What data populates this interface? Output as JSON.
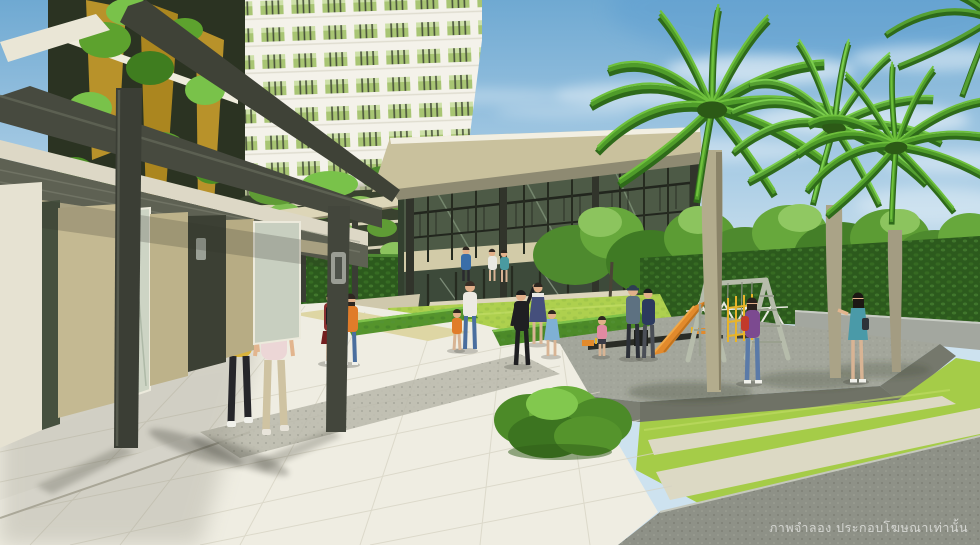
{
  "image": {
    "type": "architectural-rendering",
    "subject": "Condominium courtyard: high-rise tower with vertical gardens, glass clubhouse, playground with wooden swing set and slide, tall fan palms, lawns, hedges and residents walking",
    "width": 980,
    "height": 545
  },
  "watermark": {
    "text": "ภาพจำลอง ประกอบโฆษณาเท่านั้น",
    "meaning": "Simulated image, for advertising purposes only",
    "color": "#ffffff"
  },
  "palette": {
    "sky_top": "#6fa9d2",
    "sky_horizon": "#cde2ef",
    "tower_facade": "#f3f1e8",
    "window_glass": "#9dbd60",
    "window_frame": "#2f3a20",
    "gold_panel": "#b8922a",
    "vine_green": "#5da22e",
    "roof_fascia": "#c9c19d",
    "structure_dark": "#44473c",
    "wall_beige": "#bdb28c",
    "hedge_dark": "#2c5a1d",
    "hedge_bright": "#55942c",
    "lawn_green": "#a8cf4a",
    "pavement_light": "#eceadf",
    "paving_dark": "#8e9187",
    "platform_grey": "#a3a69b",
    "palm_trunk": "#b3ac8d",
    "palm_leaf": "#4f9c2a",
    "slide_orange": "#e28a2c",
    "swing_wood": "#b6bcab",
    "seesaw_dark": "#2a2c26"
  },
  "scene": {
    "buildings": [
      {
        "name": "residential-tower",
        "description": "white high-rise, grid of green glass windows, upper left"
      },
      {
        "name": "left-wing-vertical-garden",
        "description": "gold panels overgrown with climbing vines, steel pergola walkway in front"
      },
      {
        "name": "parking-podium",
        "description": "slab edges with hanging vine curtains behind green hedge wall"
      },
      {
        "name": "clubhouse",
        "description": "two-storey glass pavilion with wide flat roof, balcony railing, entry steps"
      }
    ],
    "playground": {
      "platform": "raised grey granite terrace",
      "equipment": [
        "wooden A-frame swing set",
        "orange slide",
        "yellow climbing frame",
        "black seesaw with orange seats",
        "white trestle fence"
      ]
    },
    "vegetation": [
      "three tall fan palms",
      "row of broadleaf trees",
      "trimmed hedge wall",
      "bright hedge blocks",
      "striped lawns"
    ],
    "people": [
      {
        "label": "woman walking, yellow top, black capris, blue backpack"
      },
      {
        "label": "woman walking, pale pink top, khaki trousers"
      },
      {
        "label": "girl standing, maroon top, red skirt, black backpack"
      },
      {
        "label": "woman standing, orange top, jeans"
      },
      {
        "label": "man at clubhouse door, blue shirt"
      },
      {
        "label": "woman at clubhouse door, white dress"
      },
      {
        "label": "woman at clubhouse door, teal top"
      },
      {
        "label": "woman on lawn, white top, jeans"
      },
      {
        "label": "boy on lawn, orange shirt"
      },
      {
        "label": "man in black playing ball with children"
      },
      {
        "label": "woman, dark blue pinafore dress"
      },
      {
        "label": "girl, light blue dress"
      },
      {
        "label": "toddler, pink top"
      },
      {
        "label": "man with cap, grey-blue top, by seesaw"
      },
      {
        "label": "man, navy top, by seesaw"
      },
      {
        "label": "woman by palms, purple top, red shoulder bag, jeans"
      },
      {
        "label": "woman by palms, teal dress"
      }
    ]
  }
}
